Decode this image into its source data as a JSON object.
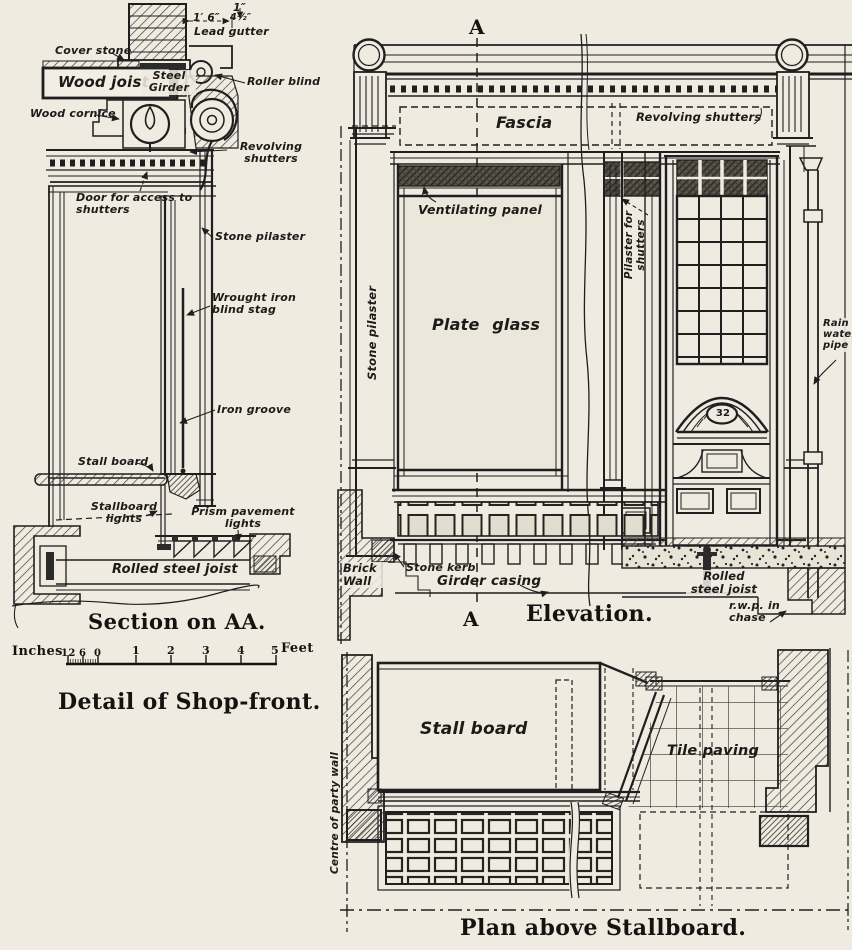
{
  "page": {
    "paper_color": "#efebe1",
    "ink_color": "#1f1f1f"
  },
  "section": {
    "title": "Section on AA.",
    "labels": {
      "dim_top": "1″",
      "dim_width": "1′ 6″",
      "dim_depth": "4½″",
      "lead_gutter": "Lead gutter",
      "cover_stone": "Cover stone",
      "wood_joist": "Wood joist",
      "steel_girder": "Steel Girder",
      "roller_blind": "Roller blind",
      "wood_cornice": "Wood cornice",
      "revolving_shutters": "Revolving shutters",
      "door_access": "Door for access to shutters",
      "stone_pilaster": "Stone pilaster",
      "blind_stag": "Wrought iron blind stag",
      "iron_groove": "Iron groove",
      "stall_board": "Stall board",
      "stallboard_lights": "Stallboard lights",
      "prism_lights": "Prism pavement lights",
      "rolled_steel_joist": "Rolled steel joist"
    }
  },
  "scale_bar": {
    "left_unit": "Inches",
    "right_unit": "Feet",
    "inch_ticks": [
      "12",
      "6",
      "0"
    ],
    "feet_ticks": [
      "1",
      "2",
      "3",
      "4",
      "5"
    ]
  },
  "main_title": "Detail of Shop-front.",
  "elevation": {
    "title": "Elevation.",
    "marker_top": "A",
    "marker_bottom": "A",
    "labels": {
      "fascia": "Fascia",
      "revolving_shutters": "Revolving shutters",
      "ventilating_panel": "Ventilating panel",
      "plate_glass": "Plate glass",
      "stone_pilaster": "Stone pilaster",
      "pilaster_for_shutters": "Pilaster for shutters",
      "house_number": "32",
      "rain_water_pipe": "Rain water pipe",
      "brick_wall": "Brick Wall",
      "stone_kerb": "Stone kerb",
      "girder_casing": "Girder casing",
      "rolled_steel_joist": "Rolled steel joist",
      "rwp_in_chase": "r.w.p. in chase"
    }
  },
  "plan": {
    "title": "Plan above Stallboard.",
    "labels": {
      "stall_board": "Stall board",
      "tile_paving": "Tile paving",
      "centre_party_wall": "Centre of party wall"
    }
  }
}
